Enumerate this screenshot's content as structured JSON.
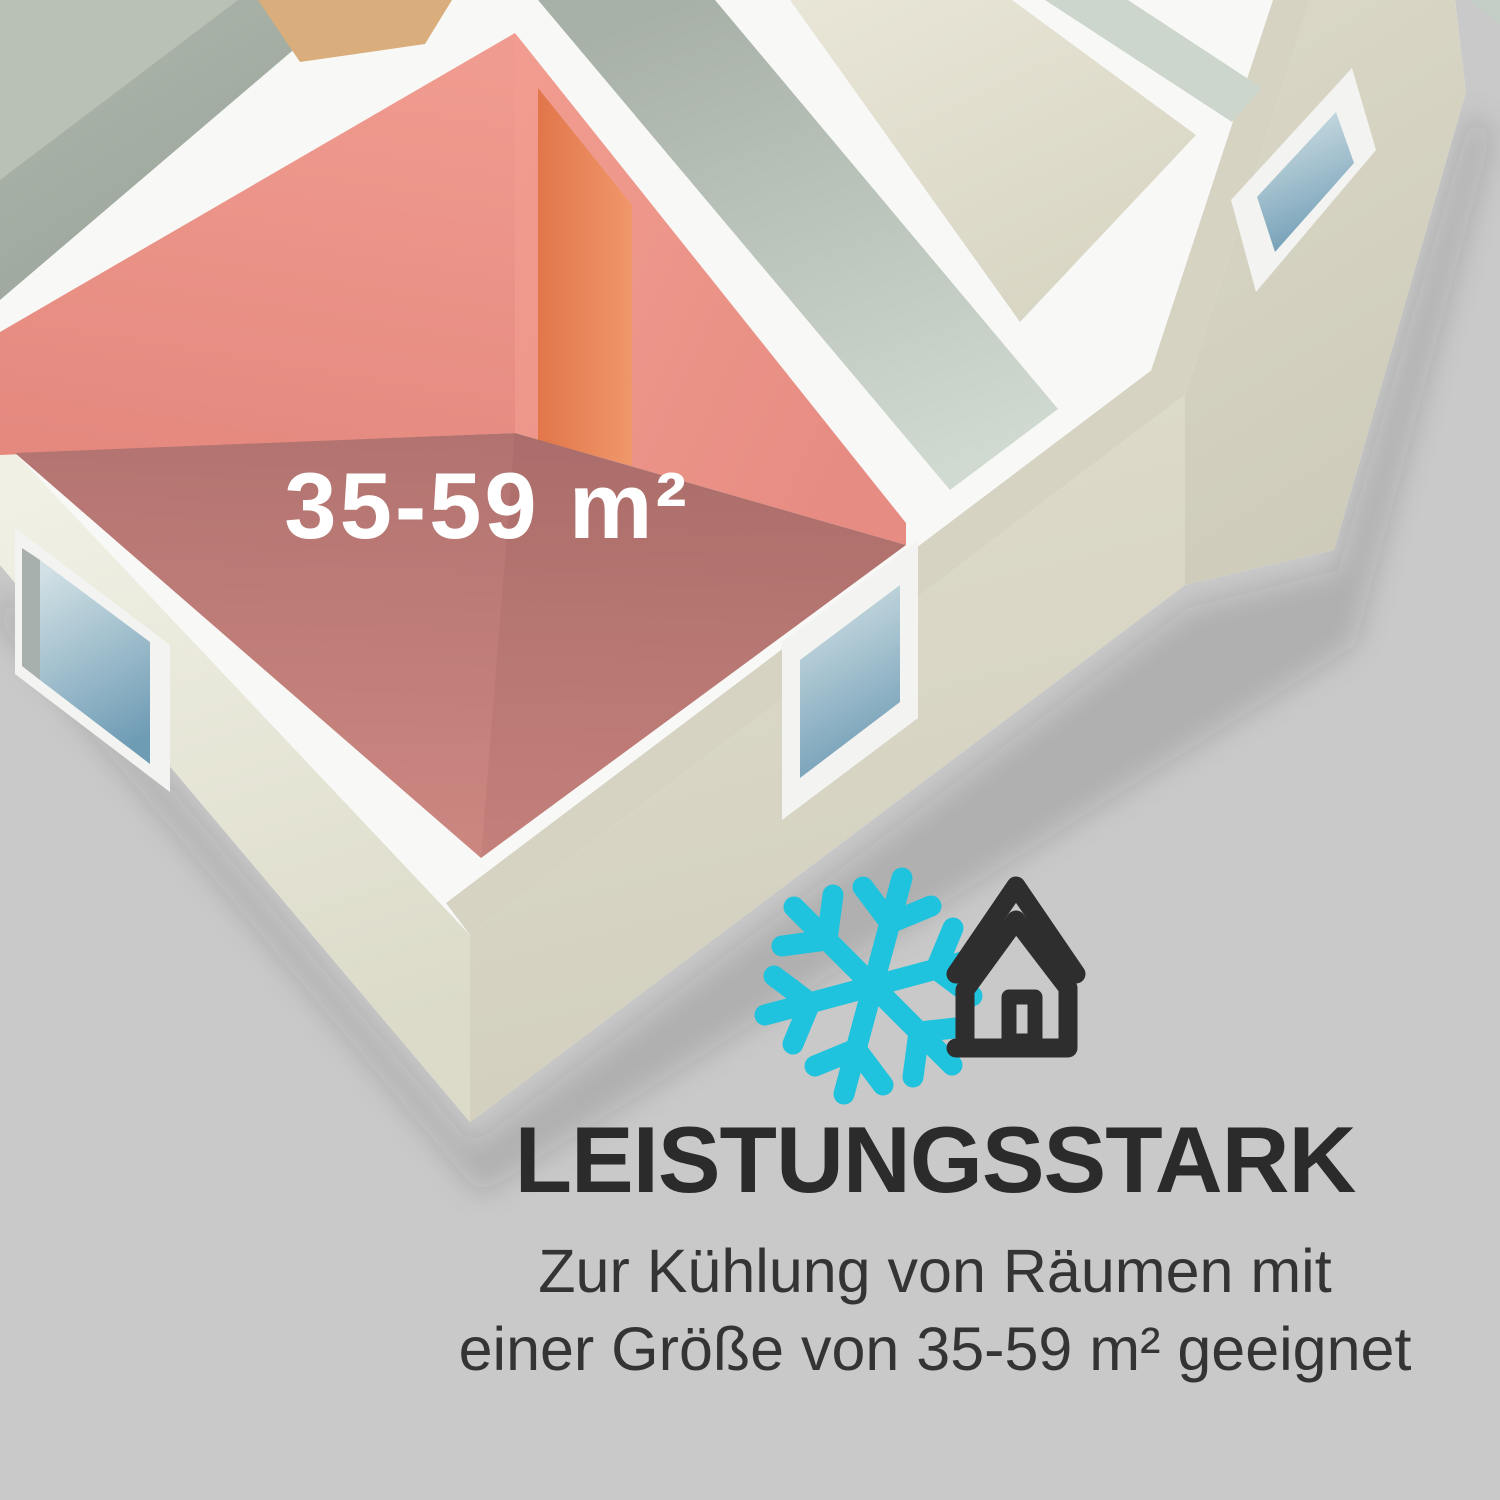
{
  "background_color": "#c8c9c8",
  "floorplan": {
    "room_size_label": "35-59 m²",
    "colors": {
      "highlight_wall": "#ee948a",
      "highlight_floor": "#c5807a",
      "highlight_door": "#e8854f",
      "corridor_floor": "#ccd6cc",
      "room_cream_floor": "#ddd9c8",
      "room_green_floor": "#a6afa3",
      "tan_door": "#d9ae7c",
      "wall_top": "#f8f9f7",
      "facade": "#e3e1d3",
      "facade_beige_top": "#d6d3c3",
      "window_frame": "#f3f4f1",
      "window_glass": "#8fb3c6"
    }
  },
  "feature": {
    "icons": [
      {
        "name": "snowflake-icon",
        "color": "#1fc3de"
      },
      {
        "name": "house-icon",
        "color": "#2e2e2e"
      }
    ],
    "heading": "LEISTUNGSSTARK",
    "description_line1": "Zur Kühlung von Räumen mit",
    "description_line2": "einer Größe von 35-59 m² geeignet",
    "heading_color": "#2b2b2b",
    "body_color": "#343434"
  }
}
